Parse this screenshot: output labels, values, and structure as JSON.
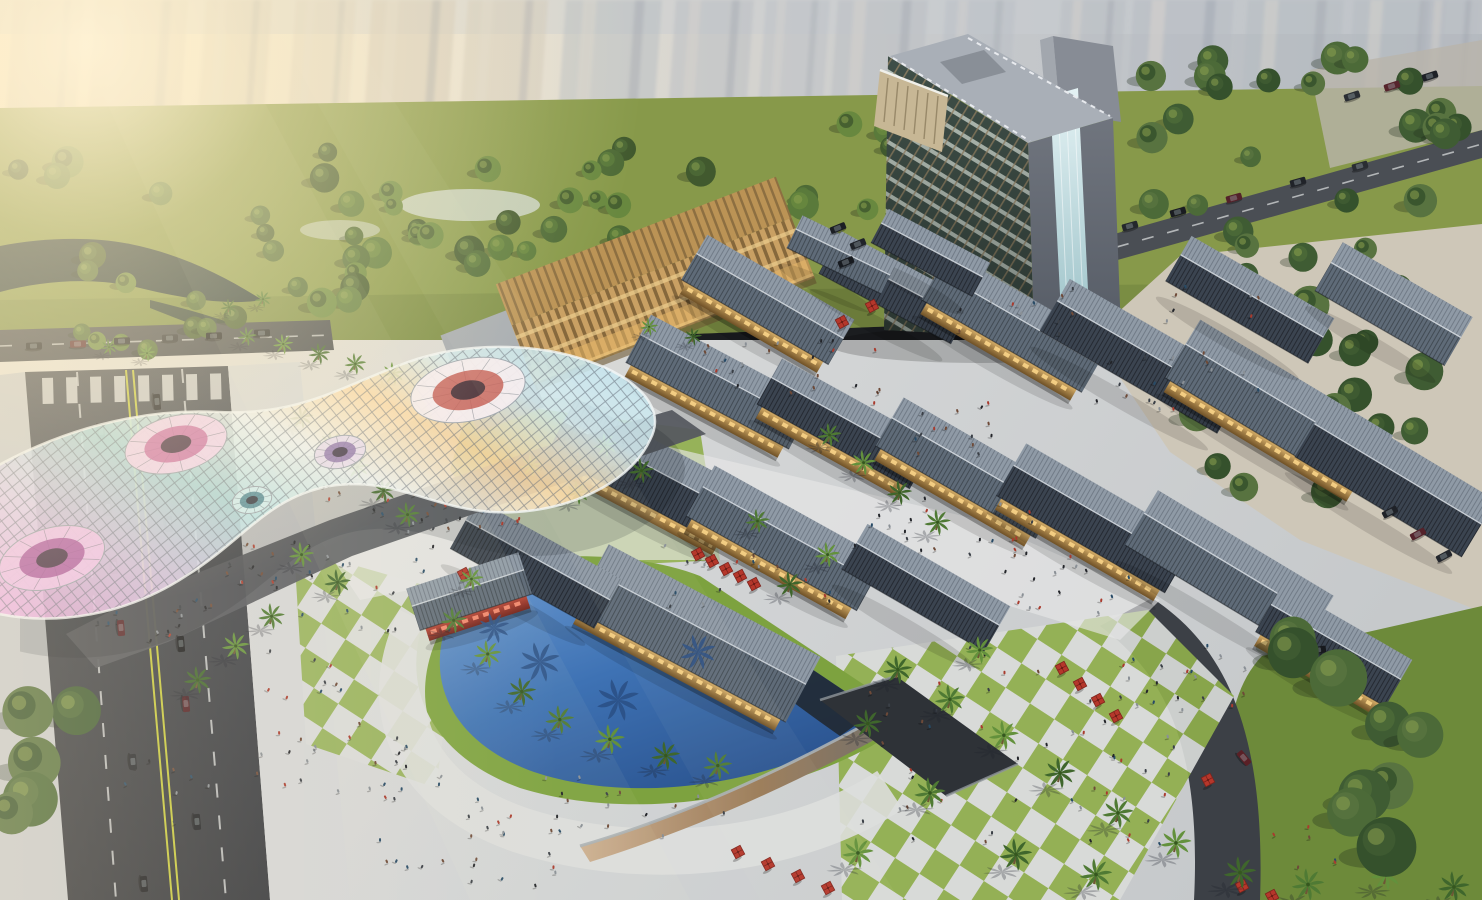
{
  "meta": {
    "type": "architectural-aerial-rendering",
    "subject": "Mixed-use retail village with hotel tower, iridescent gridshell canopy, pool plaza, parkland and roads",
    "width": 1482,
    "height": 900
  },
  "palette": {
    "hazeWarm": "#f6e8cd",
    "hazeCool": "#b4b9bf",
    "ghost": "#b6bbc2",
    "ghostWarm": "#cdc5b8",
    "grass": "#8fae4b",
    "park": "#87994a",
    "treeMid": "#5a7a3b",
    "water": "#1e2f38",
    "pool": "#3e72b4",
    "poolShadow": "#2a4f84",
    "paver": "#d9dbd9",
    "road": "#3f434a",
    "laneYellow": "#c6c93e",
    "laneWhite": "#dfe2e2",
    "roofLight": "#8f9aa6",
    "roofMid": "#5f6b78",
    "roofDark": "#3b4450",
    "facadeGlow": "#e7bd72",
    "accentRed": "#b5372b",
    "slatGold": "#c9a063",
    "towerGlass": "#3f4f48",
    "mullion": "#9a8766",
    "canopyPink": "#efb5e6",
    "canopyCyan": "#bce8ea",
    "canopyWarm": "#fcd9a4",
    "people": "#23252a"
  },
  "scene": {
    "ghost_towers": [
      [
        14,
        70,
        330,
        0.5,
        1
      ],
      [
        96,
        92,
        300,
        0.55,
        1
      ],
      [
        206,
        66,
        276,
        0.45,
        1
      ],
      [
        296,
        60,
        240,
        0.4,
        1
      ],
      [
        372,
        84,
        330,
        0.6,
        1
      ],
      [
        468,
        80,
        296,
        0.5,
        1
      ],
      [
        566,
        96,
        276,
        0.5,
        0
      ],
      [
        676,
        78,
        240,
        0.45,
        0
      ],
      [
        766,
        64,
        210,
        0.4,
        0
      ],
      [
        838,
        90,
        260,
        0.45,
        0
      ],
      [
        946,
        70,
        200,
        0.4,
        0
      ],
      [
        1062,
        64,
        230,
        0.45,
        0
      ],
      [
        1134,
        100,
        310,
        0.55,
        0
      ],
      [
        1248,
        96,
        330,
        0.5,
        0
      ],
      [
        1354,
        92,
        300,
        0.5,
        0
      ],
      [
        1424,
        58,
        260,
        0.45,
        0
      ]
    ],
    "tree_regions": [
      [
        16,
        148,
        810,
        165,
        48,
        9,
        16,
        11,
        "far",
        0
      ],
      [
        846,
        118,
        290,
        100,
        14,
        8,
        13,
        7,
        "far",
        0
      ],
      [
        1124,
        56,
        350,
        250,
        30,
        10,
        17,
        5,
        "far",
        1
      ],
      [
        1156,
        262,
        310,
        240,
        15,
        12,
        20,
        9,
        "far",
        1
      ],
      [
        16,
        298,
        250,
        62,
        8,
        8,
        12,
        3,
        "far",
        0
      ],
      [
        424,
        326,
        240,
        40,
        6,
        7,
        10,
        21,
        "far",
        0
      ],
      [
        1286,
        638,
        180,
        240,
        9,
        22,
        34,
        13,
        "near",
        1
      ],
      [
        2,
        676,
        110,
        180,
        5,
        18,
        30,
        17,
        "near",
        1
      ]
    ],
    "palms": [
      [
        246,
        342,
        0.8
      ],
      [
        282,
        350,
        0.85
      ],
      [
        318,
        360,
        0.9
      ],
      [
        354,
        370,
        0.9
      ],
      [
        392,
        380,
        0.95
      ],
      [
        300,
        424,
        1
      ],
      [
        330,
        450,
        1
      ],
      [
        356,
        474,
        1
      ],
      [
        382,
        498,
        1.05
      ],
      [
        406,
        522,
        1.05
      ],
      [
        300,
        562,
        1.05
      ],
      [
        336,
        590,
        1.1
      ],
      [
        270,
        624,
        1.1
      ],
      [
        234,
        654,
        1.15
      ],
      [
        196,
        688,
        1.15
      ],
      [
        452,
        628,
        1.1
      ],
      [
        486,
        662,
        1.15
      ],
      [
        520,
        700,
        1.2
      ],
      [
        558,
        728,
        1.2
      ],
      [
        608,
        748,
        1.25
      ],
      [
        664,
        764,
        1.2
      ],
      [
        716,
        774,
        1.2
      ],
      [
        470,
        586,
        1
      ],
      [
        896,
        678,
        1.2
      ],
      [
        948,
        708,
        1.25
      ],
      [
        1002,
        744,
        1.25
      ],
      [
        1058,
        782,
        1.3
      ],
      [
        1116,
        822,
        1.3
      ],
      [
        978,
        658,
        1.15
      ],
      [
        866,
        732,
        1.2
      ],
      [
        928,
        802,
        1.3
      ],
      [
        856,
        862,
        1.3
      ],
      [
        1014,
        864,
        1.35
      ],
      [
        1094,
        884,
        1.35
      ],
      [
        1174,
        852,
        1.3
      ],
      [
        1238,
        882,
        1.35
      ],
      [
        1306,
        894,
        1.35
      ],
      [
        1384,
        884,
        1.3
      ],
      [
        1452,
        896,
        1.3
      ],
      [
        828,
        442,
        1
      ],
      [
        862,
        470,
        1.05
      ],
      [
        898,
        500,
        1.05
      ],
      [
        936,
        530,
        1.1
      ],
      [
        826,
        562,
        1.05
      ],
      [
        788,
        592,
        1.1
      ],
      [
        756,
        528,
        1
      ],
      [
        604,
        452,
        1
      ],
      [
        640,
        478,
        1.05
      ],
      [
        576,
        500,
        1
      ],
      [
        530,
        472,
        0.95
      ],
      [
        228,
        312,
        0.7
      ],
      [
        262,
        304,
        0.7
      ],
      [
        648,
        332,
        0.75
      ],
      [
        692,
        342,
        0.75
      ],
      [
        108,
        352,
        0.7
      ],
      [
        146,
        358,
        0.7
      ]
    ],
    "pool_palm_shadows": [
      [
        540,
        662,
        1.7
      ],
      [
        618,
        700,
        1.8
      ],
      [
        698,
        652,
        1.5
      ],
      [
        494,
        628,
        1.3
      ]
    ],
    "roofs": [
      [
        770,
        296,
        170,
        52,
        30,
        1,
        0
      ],
      [
        898,
        284,
        150,
        48,
        28,
        0,
        1
      ],
      [
        1018,
        318,
        185,
        56,
        30,
        1,
        0
      ],
      [
        1146,
        352,
        205,
        60,
        30,
        0,
        1
      ],
      [
        1282,
        402,
        225,
        68,
        31,
        1,
        0
      ],
      [
        1398,
        474,
        195,
        66,
        31,
        0,
        1
      ],
      [
        722,
        378,
        185,
        54,
        28,
        1,
        0
      ],
      [
        848,
        420,
        175,
        52,
        29,
        1,
        1
      ],
      [
        972,
        464,
        185,
        56,
        30,
        1,
        0
      ],
      [
        1098,
        514,
        195,
        60,
        30,
        1,
        1
      ],
      [
        1232,
        566,
        205,
        64,
        31,
        0,
        0
      ],
      [
        652,
        468,
        200,
        62,
        28,
        1,
        1
      ],
      [
        788,
        534,
        195,
        58,
        29,
        1,
        0
      ],
      [
        928,
        584,
        165,
        52,
        30,
        0,
        1
      ],
      [
        700,
        628,
        240,
        74,
        28,
        1,
        0
      ],
      [
        538,
        560,
        165,
        56,
        29,
        0,
        1
      ],
      [
        468,
        588,
        118,
        44,
        -18,
        2,
        0
      ],
      [
        1336,
        642,
        150,
        54,
        30,
        1,
        1
      ],
      [
        1252,
        296,
        165,
        52,
        30,
        0,
        1
      ],
      [
        1396,
        300,
        150,
        56,
        30,
        0,
        0
      ],
      [
        932,
        250,
        115,
        38,
        28,
        0,
        1
      ],
      [
        843,
        252,
        105,
        36,
        26,
        0,
        0
      ]
    ],
    "people_clusters": [
      [
        92,
        598,
        120,
        52,
        16
      ],
      [
        222,
        544,
        140,
        52,
        18
      ],
      [
        380,
        488,
        150,
        46,
        18
      ],
      [
        520,
        438,
        140,
        42,
        14
      ],
      [
        300,
        478,
        150,
        160,
        26
      ],
      [
        248,
        648,
        150,
        140,
        20
      ],
      [
        430,
        778,
        330,
        70,
        26
      ],
      [
        300,
        718,
        110,
        90,
        14
      ],
      [
        660,
        538,
        180,
        70,
        20
      ],
      [
        840,
        498,
        200,
        70,
        22
      ],
      [
        1000,
        558,
        140,
        60,
        16
      ],
      [
        700,
        338,
        180,
        70,
        22
      ],
      [
        898,
        398,
        120,
        60,
        14
      ],
      [
        858,
        648,
        330,
        200,
        55
      ],
      [
        1138,
        638,
        110,
        70,
        14
      ],
      [
        1108,
        268,
        170,
        140,
        16
      ],
      [
        1078,
        358,
        100,
        60,
        8
      ],
      [
        360,
        818,
        220,
        70,
        16
      ],
      [
        120,
        758,
        100,
        80,
        8
      ],
      [
        1268,
        818,
        80,
        60,
        6
      ],
      [
        950,
        290,
        130,
        50,
        12
      ]
    ],
    "cars": [
      [
        157,
        402,
        85,
        "#1b1d22"
      ],
      [
        163,
        462,
        85,
        "#58222a"
      ],
      [
        169,
        524,
        85,
        "#23262c"
      ],
      [
        181,
        644,
        85,
        "#17191d"
      ],
      [
        186,
        704,
        85,
        "#501e24"
      ],
      [
        197,
        822,
        85,
        "#1c1f24"
      ],
      [
        101,
        432,
        85,
        "#202329"
      ],
      [
        108,
        508,
        85,
        "#2b2e33"
      ],
      [
        114,
        566,
        85,
        "#17191d"
      ],
      [
        121,
        628,
        85,
        "#55242a"
      ],
      [
        133,
        762,
        85,
        "#25282e"
      ],
      [
        144,
        884,
        85,
        "#191b20"
      ],
      [
        34,
        346,
        -2,
        "#1d2026"
      ],
      [
        78,
        344,
        -2,
        "#55242a"
      ],
      [
        122,
        341,
        -2,
        "#202329"
      ],
      [
        170,
        338,
        -2,
        "#2b2e34"
      ],
      [
        214,
        336,
        -2,
        "#17191e"
      ],
      [
        262,
        333,
        -2,
        "#23262b"
      ],
      [
        1130,
        226,
        -16,
        "#24272c"
      ],
      [
        1178,
        212,
        -16,
        "#1a1c21"
      ],
      [
        1234,
        198,
        -16,
        "#53222a"
      ],
      [
        1298,
        182,
        -16,
        "#202329"
      ],
      [
        1360,
        166,
        -16,
        "#2a2d32"
      ],
      [
        1352,
        96,
        -18,
        "#2a2e34"
      ],
      [
        1392,
        86,
        -18,
        "#56242c"
      ],
      [
        1430,
        76,
        -18,
        "#1e2127"
      ],
      [
        1318,
        650,
        -8,
        "#17191d"
      ],
      [
        1244,
        758,
        50,
        "#5a2026"
      ],
      [
        1390,
        512,
        -28,
        "#1f2228"
      ],
      [
        1418,
        534,
        -28,
        "#54222a"
      ],
      [
        1444,
        556,
        -28,
        "#24272d"
      ],
      [
        838,
        228,
        -22,
        "#1c1f24"
      ],
      [
        858,
        244,
        -22,
        "#202329"
      ],
      [
        846,
        262,
        -22,
        "#171a1f"
      ]
    ],
    "umbrellas": [
      [
        698,
        554
      ],
      [
        712,
        561
      ],
      [
        726,
        569
      ],
      [
        740,
        576
      ],
      [
        754,
        584
      ],
      [
        1062,
        668
      ],
      [
        1080,
        684
      ],
      [
        1098,
        700
      ],
      [
        1116,
        716
      ],
      [
        1208,
        780
      ],
      [
        738,
        852
      ],
      [
        768,
        864
      ],
      [
        798,
        876
      ],
      [
        828,
        888
      ],
      [
        1242,
        886
      ],
      [
        1272,
        896
      ],
      [
        872,
        306
      ],
      [
        842,
        322
      ],
      [
        464,
        574
      ]
    ],
    "canopy_funnels": [
      [
        176,
        444,
        52,
        28,
        -14,
        "#f2d4ee",
        "#c9699f"
      ],
      [
        468,
        390,
        58,
        31,
        -12,
        "#f6eef2",
        "#c25a52"
      ],
      [
        52,
        558,
        54,
        30,
        -16,
        "#efc2ea",
        "#a8509a"
      ],
      [
        252,
        500,
        20,
        13,
        -14,
        "#d2eef0",
        "#47808e"
      ],
      [
        340,
        452,
        26,
        16,
        -13,
        "#e8ddf0",
        "#8a6ea8"
      ]
    ]
  }
}
